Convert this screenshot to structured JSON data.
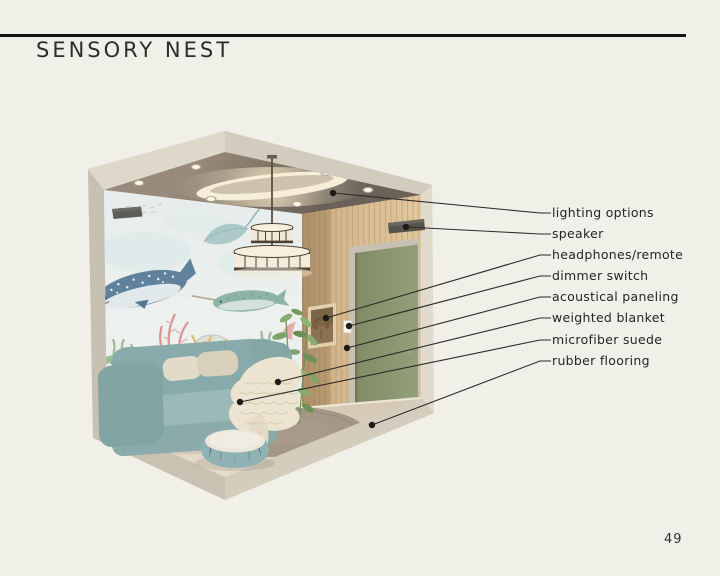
{
  "page": {
    "title": "SENSORY NEST",
    "page_number": "49",
    "background_color": "#f0efe8",
    "rule_color": "#171513"
  },
  "annotations": [
    {
      "label": "lighting options",
      "target": "oval cove light and recessed downlights in ceiling"
    },
    {
      "label": "speaker",
      "target": "wall-mounted speaker on wood wall"
    },
    {
      "label": "headphones/remote",
      "target": "recessed wall niche holding headphones"
    },
    {
      "label": "dimmer switch",
      "target": "white switch plate beside niche"
    },
    {
      "label": "acoustical paneling",
      "target": "vertical wood slat wall"
    },
    {
      "label": "weighted blanket",
      "target": "cream knit blanket draped on sofa"
    },
    {
      "label": "microfiber suede",
      "target": "teal sofa upholstery"
    },
    {
      "label": "rubber flooring",
      "target": "beige floor"
    }
  ],
  "illustration": {
    "description": "isometric cutaway rendering of a calming sensory room",
    "room_features": [
      "underwater watercolor mural with whale shark, stingray and narwhal",
      "two-tier drum pendant light",
      "oval ceiling cove light with recessed downlights",
      "sage green door in wood slat wall",
      "teal sofa with cream pillows and chunky knit blanket",
      "round teal pouf with light top",
      "round taupe rug",
      "potted leafy plant in corner",
      "two dark wall speakers",
      "headphone niche and dimmer switch plate"
    ],
    "colors": {
      "shell": "#d8d2c4",
      "ceiling": "#7d7269",
      "cove_glow": "#fbf3dd",
      "mural_background": "#f3f7f5",
      "whale": "#5e7f9c",
      "sea_creature_teal": "#9cc4c0",
      "wood_paneling": "#d5b88e",
      "door": "#8a9772",
      "floor": "#ded3c1",
      "rug": "#a59786",
      "sofa": "#8fb0b0",
      "blanket": "#ece3d1",
      "leader_line": "#2e2a25"
    }
  }
}
